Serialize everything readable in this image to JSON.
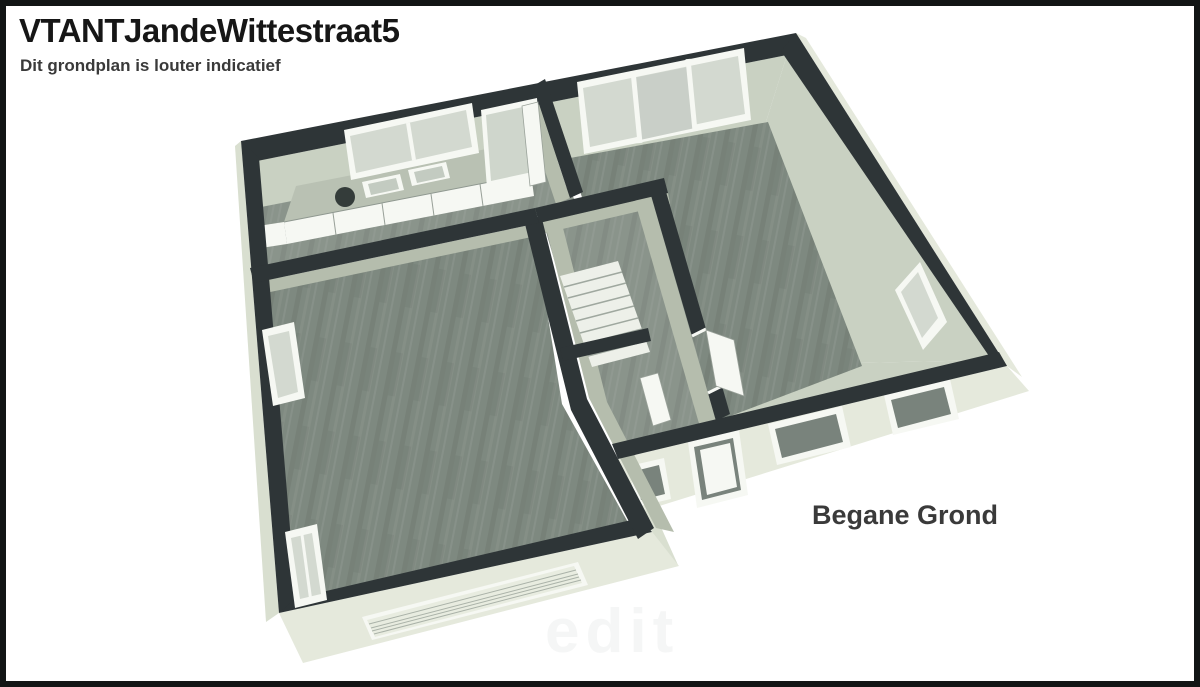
{
  "header": {
    "title": "VTANTJandeWittestraat5",
    "subtitle": "Dit grondplan is louter indicatief"
  },
  "plan": {
    "floor_label": "Begane Grond",
    "watermark": "edit",
    "view": "3D isometric floor plan, ground floor"
  },
  "colors": {
    "frame": "#121515",
    "background": "#ffffff",
    "wall": "#2e3537",
    "wallFace": "#c9d1c2",
    "wallFaceDark": "#b5bdad",
    "exterior": "#e5e9dc",
    "exteriorDark": "#d9dfd0",
    "floorWood": "#7e8980",
    "floorWoodLight": "#8a948b",
    "floorHall": "#939c93",
    "stairs": "#edf0e9",
    "frameWhite": "#f6f8f3",
    "glass": "#d3d9d0",
    "glassDark": "#c9cfc8",
    "openingDark": "#79837c",
    "text": "#161616",
    "subtext": "#3a3a3a"
  }
}
